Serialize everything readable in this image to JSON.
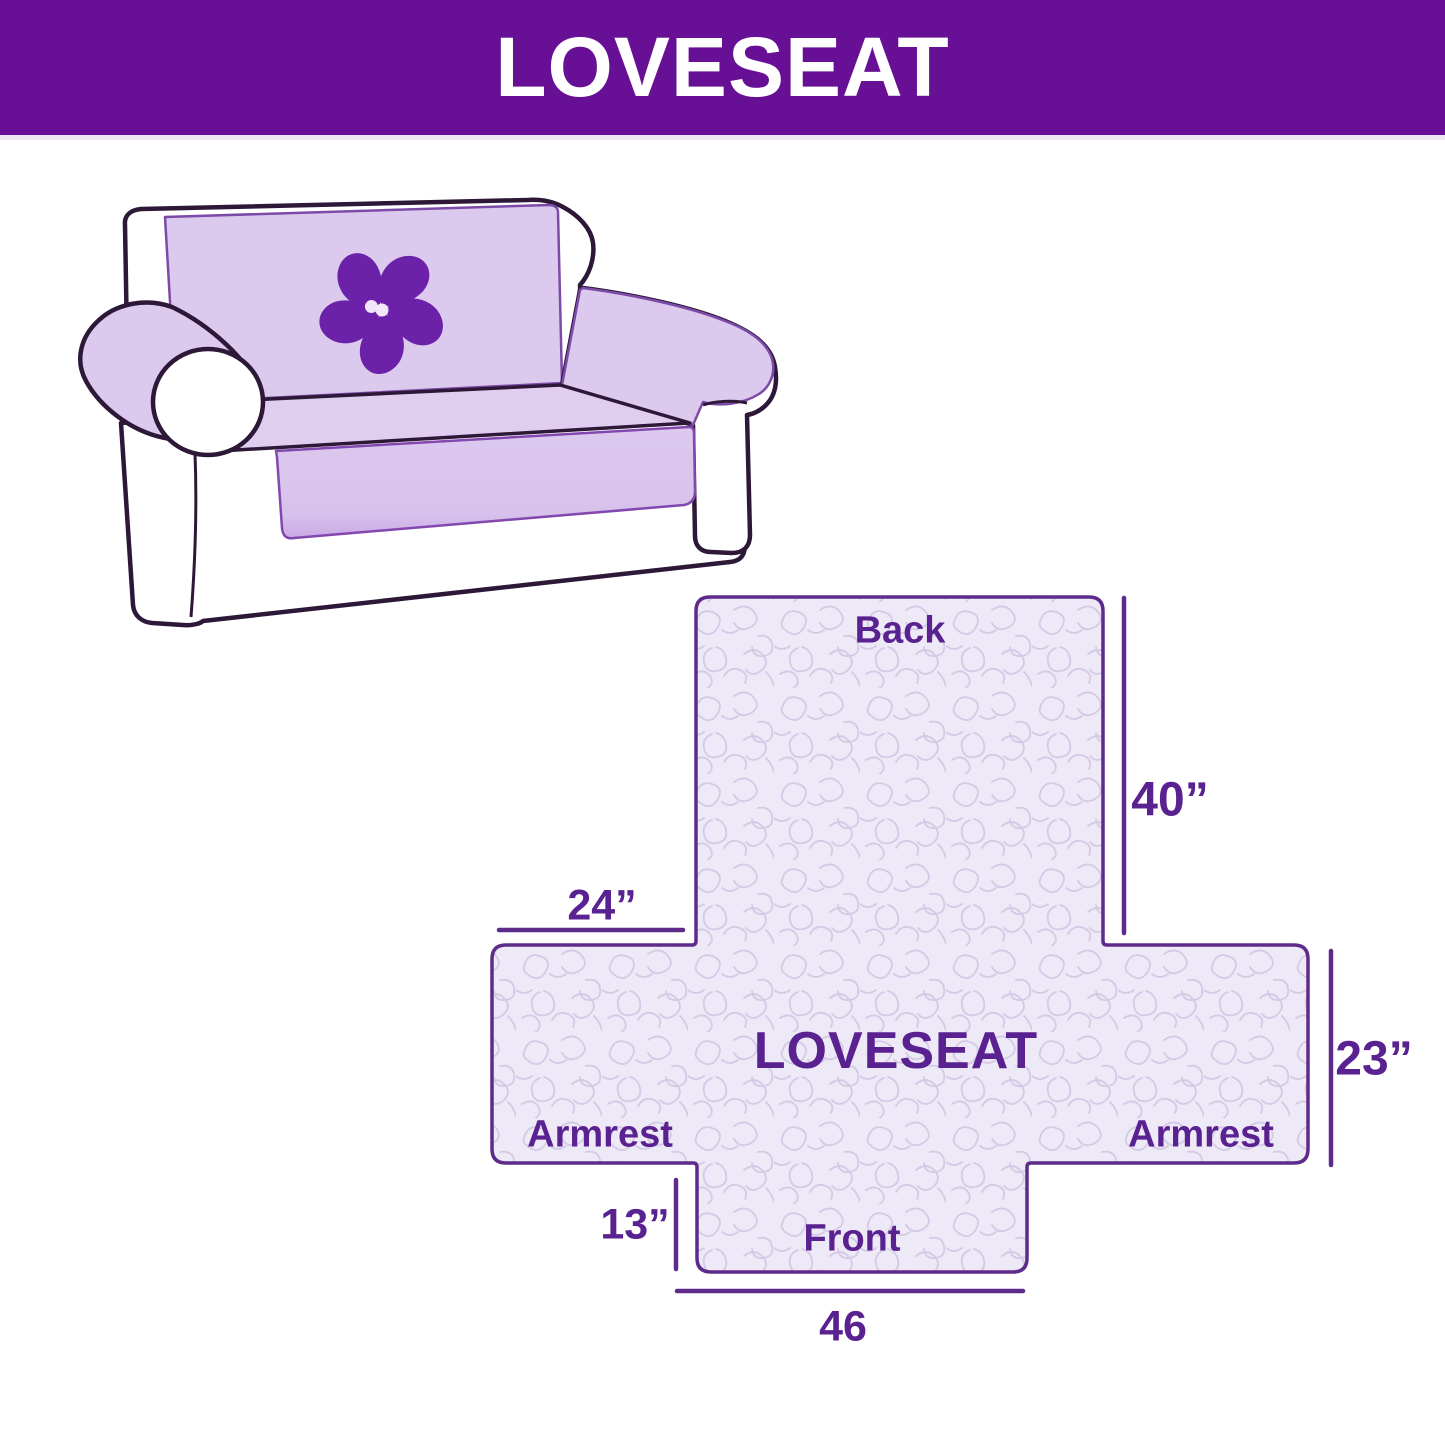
{
  "header": {
    "title": "LOVESEAT",
    "bg_color": "#671095",
    "text_color": "#FFFFFF"
  },
  "illustration": {
    "description": "loveseat sofa wearing quilted slipcover",
    "logo_icon": "pinwheel-icon",
    "cover_color": "#DCC9EE",
    "logo_color": "#6B21A8",
    "outline_color": "#2E1838"
  },
  "diagram": {
    "center_label": "LOVESEAT",
    "back_label": "Back",
    "front_label": "Front",
    "armrest_left_label": "Armrest",
    "armrest_right_label": "Armrest",
    "dim_back_height": "40”",
    "dim_back_width": "24”",
    "dim_armrest_height": "23”",
    "dim_front_height": "13”",
    "dim_front_width": "46",
    "accent_color": "#5A2191",
    "fill_color": "#EDE9F6",
    "pattern_color": "#D4CAE6",
    "line_color": "#5E2B8A"
  }
}
